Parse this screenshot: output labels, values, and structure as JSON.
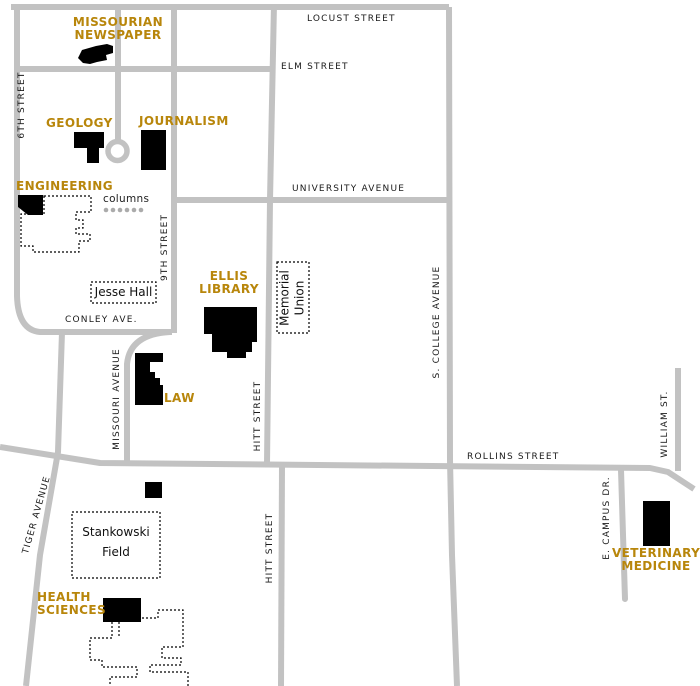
{
  "map": {
    "title": "campus map",
    "streets": {
      "locust": "LOCUST STREET",
      "elm": "ELM STREET",
      "university": "UNIVERSITY AVENUE",
      "conley": "CONLEY AVE.",
      "rollins": "ROLLINS STREET",
      "sixth": "6TH STREET",
      "ninth": "9TH STREET",
      "missouri": "MISSOURI AVENUE",
      "hitt_north": "HITT STREET",
      "hitt_south": "HITT STREET",
      "s_college": "S. COLLEGE AVENUE",
      "william": "WILLIAM ST.",
      "e_campus": "E. CAMPUS DR.",
      "tiger": "TIGER AVENUE"
    },
    "buildings": {
      "missourian": {
        "line1": "MISSOURIAN",
        "line2": "NEWSPAPER"
      },
      "geology": "GEOLOGY",
      "journalism": "JOURNALISM",
      "engineering": "ENGINEERING",
      "ellis": {
        "line1": "ELLIS",
        "line2": "LIBRARY"
      },
      "law": "LAW",
      "health": {
        "line1": "HEALTH",
        "line2": "SCIENCES"
      },
      "veterinary": {
        "line1": "VETERINARY",
        "line2": "MEDICINE"
      }
    },
    "places": {
      "jesse_hall": "Jesse Hall",
      "memorial_union": {
        "line1": "Memorial",
        "line2": "Union"
      },
      "stankowski": {
        "line1": "Stankowski",
        "line2": "Field"
      }
    },
    "annotations": {
      "columns": "columns"
    },
    "colors": {
      "street": "#c2c2c2",
      "building_fill": "#000000",
      "building_label": "#b8860b",
      "street_label": "#1a1a1a",
      "column_dot": "#ababab"
    }
  }
}
